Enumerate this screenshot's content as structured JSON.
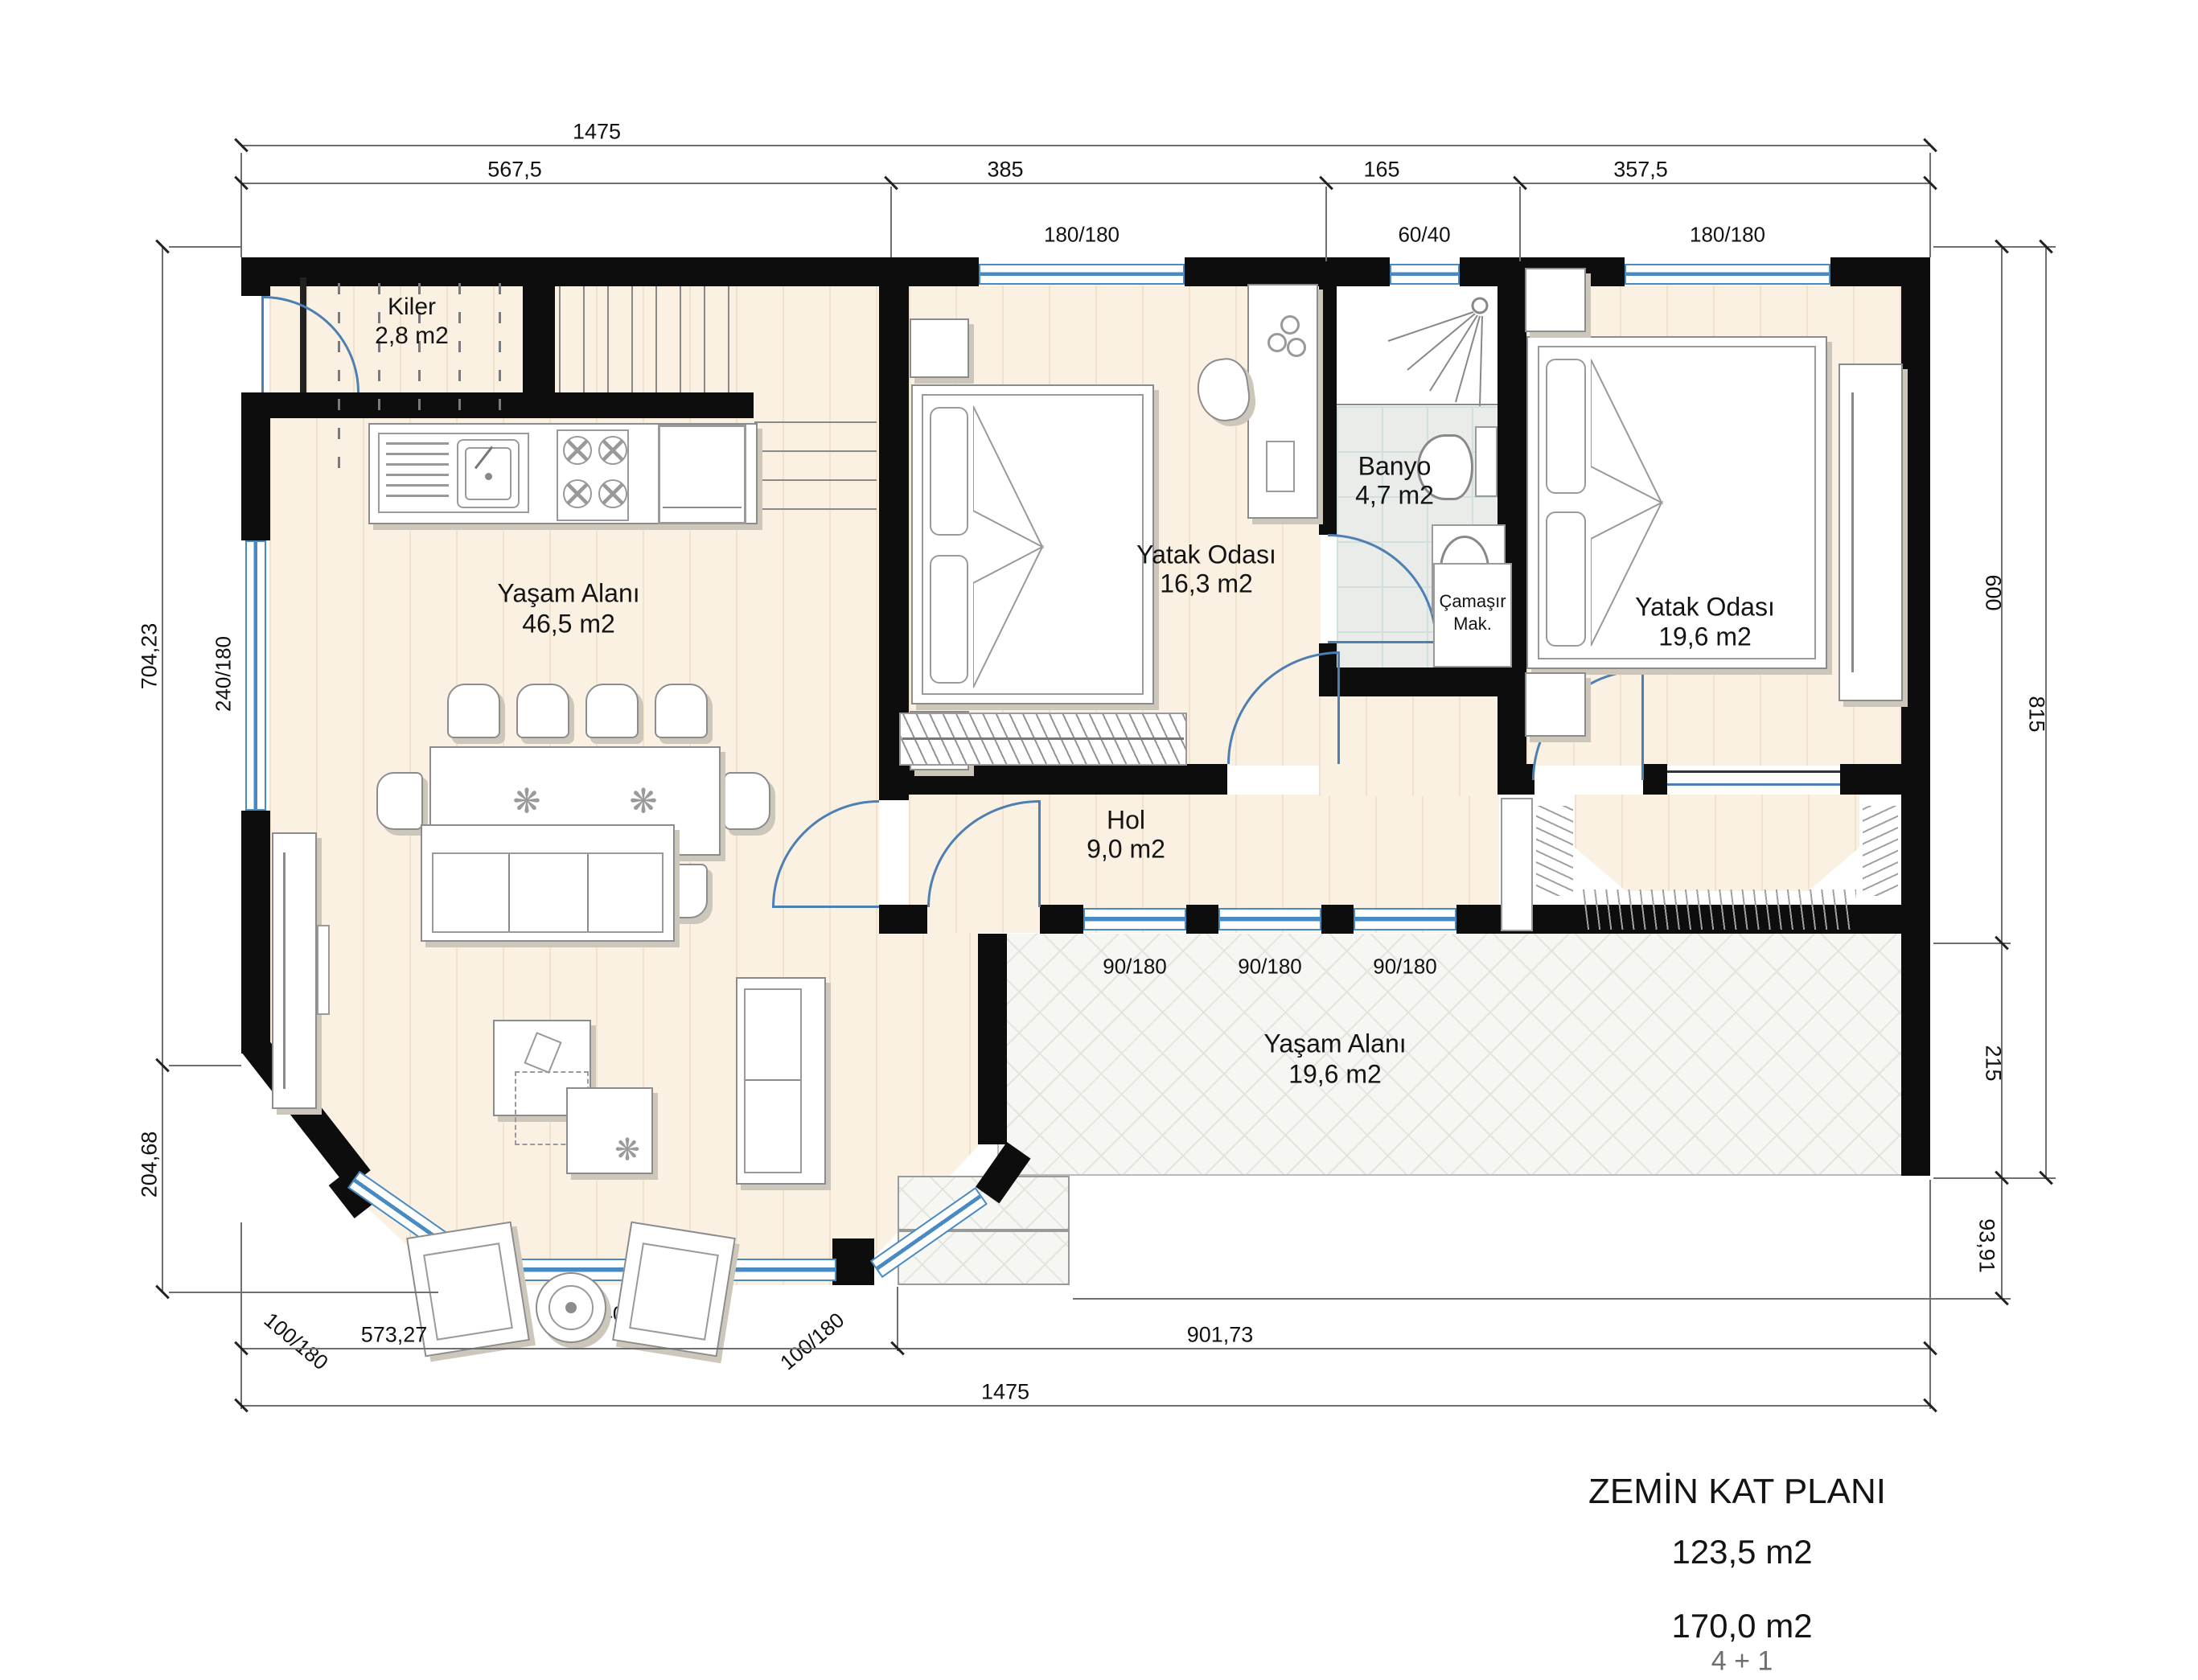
{
  "rooms": {
    "kiler": {
      "name": "Kiler",
      "area": "2,8 m2"
    },
    "living": {
      "name": "Yaşam Alanı",
      "area": "46,5 m2"
    },
    "bedroom1": {
      "name": "Yatak Odası",
      "area": "16,3 m2"
    },
    "banyo": {
      "name": "Banyo",
      "area": "4,7 m2"
    },
    "laundry": {
      "l1": "Çamaşır",
      "l2": "Mak."
    },
    "bedroom2": {
      "name": "Yatak Odası",
      "area": "19,6 m2"
    },
    "hol": {
      "name": "Hol",
      "area": "9,0 m2"
    },
    "terrace": {
      "name": "Yaşam Alanı",
      "area": "19,6 m2"
    }
  },
  "dims": {
    "top": {
      "total": "1475",
      "segs": [
        "567,5",
        "385",
        "165",
        "357,5"
      ]
    },
    "bottom": {
      "segs": [
        "573,27",
        "901,73"
      ],
      "total": "1475"
    },
    "left": [
      "704,23",
      "204,68"
    ],
    "right": [
      "600",
      "215",
      "93,91"
    ],
    "right_outer": "815"
  },
  "win": {
    "top": [
      "180/180",
      "60/40",
      "180/180"
    ],
    "left": "240/180",
    "bay_left": "100/180",
    "bay_bottom": "240/180",
    "bay_right": "100/180",
    "south": [
      "90/180",
      "90/180",
      "90/180"
    ]
  },
  "title": {
    "line1": "ZEMİN KAT PLANI",
    "line2": "123,5 m2",
    "line3": "170,0 m2",
    "line4": "4 + 1"
  },
  "deco": {
    "flower": "❋"
  },
  "colors": {
    "wall": "#0d0d0d",
    "window": "#4a8ac2",
    "door": "#4d7fb3",
    "wood": "#fbf1e3",
    "tile": "#e9ece8"
  }
}
